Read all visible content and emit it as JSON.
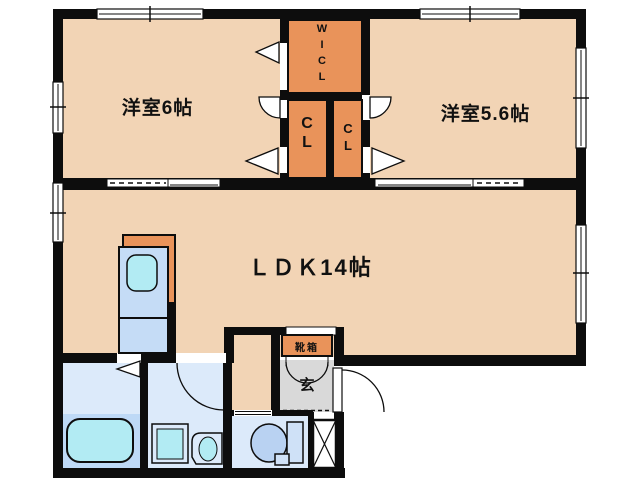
{
  "floor_plan": {
    "labels": {
      "bedroom6": "洋室6帖",
      "bedroom56": "洋室5.6帖",
      "ldk": "ＬＤＫ14帖",
      "wicl": "W\nI\nC\nL",
      "cl_left": "C\nL",
      "cl_right": "C\nL",
      "shoebox": "靴箱",
      "entrance": "玄"
    },
    "rooms": [
      {
        "id": "bedroom6",
        "name": "洋室6帖",
        "type": "western-room"
      },
      {
        "id": "bedroom56",
        "name": "洋室5.6帖",
        "type": "western-room"
      },
      {
        "id": "ldk",
        "name": "ＬＤＫ14帖",
        "type": "living-dining-kitchen"
      },
      {
        "id": "wicl",
        "name": "WICL",
        "type": "walk-in-closet"
      },
      {
        "id": "cl_left",
        "name": "CL",
        "type": "closet"
      },
      {
        "id": "cl_right",
        "name": "CL",
        "type": "closet"
      },
      {
        "id": "entrance",
        "name": "玄",
        "type": "entrance"
      },
      {
        "id": "shoebox",
        "name": "靴箱",
        "type": "shoe-cabinet"
      }
    ],
    "fixtures": [
      "bathtub",
      "washing-machine",
      "washbasin",
      "toilet",
      "kitchen-counter",
      "kitchen-sink",
      "shoe-cabinet",
      "pipe-space",
      "door-swings",
      "windows"
    ],
    "colors": {
      "floor_peach": "#f2d4b5",
      "closet_orange": "#e9935a",
      "wall_black": "#0d0d0d",
      "wet_room_floor": "#dceafa",
      "tub_area": "#bed9f6",
      "fixture_cyan": "#b2ebf3",
      "counter_blue": "#c5dcf6",
      "toilet_blue": "#b9d2f2",
      "tank_blue": "#cfe1f7",
      "entrance_gray": "#d9d9d9",
      "window_white": "#ffffff"
    }
  }
}
